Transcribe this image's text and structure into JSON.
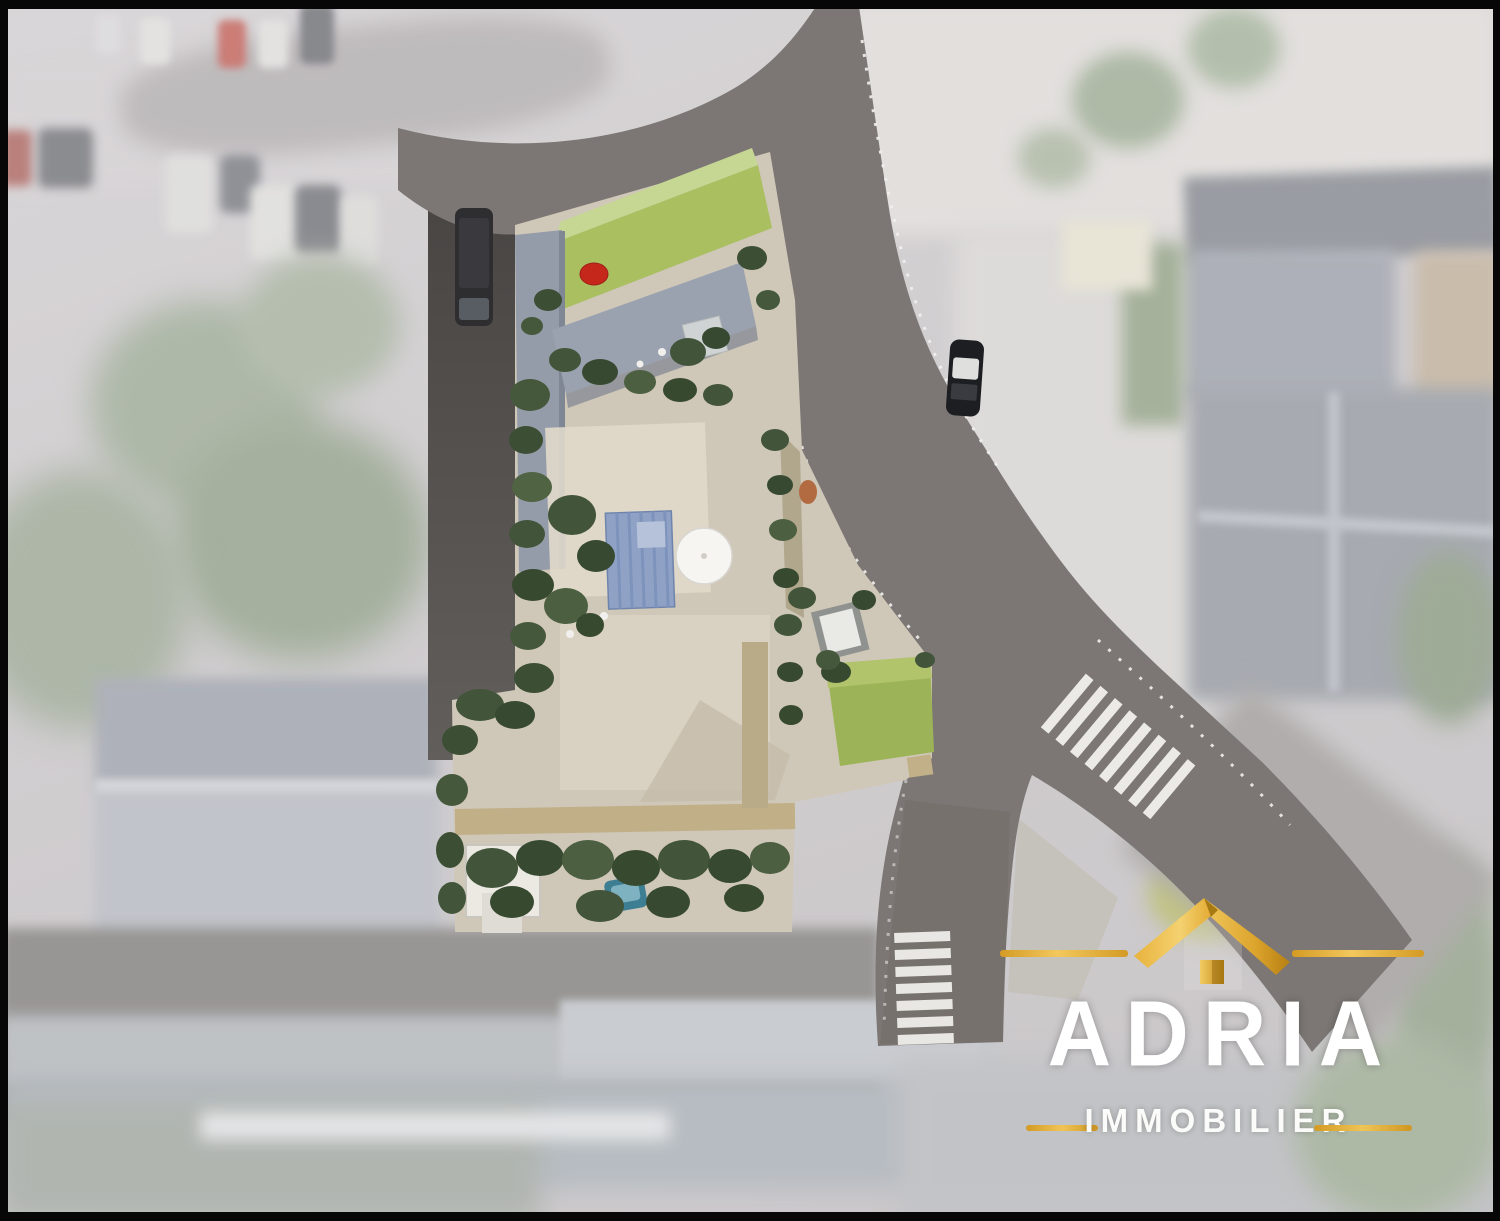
{
  "logo": {
    "brand": "ADRIA",
    "subtitle": "IMMOBILIER",
    "icon": "gold-roof-house-icon",
    "colors": {
      "gold": "#E3A72F",
      "gold_light": "#F2C75C",
      "gold_dark": "#B67F12",
      "text": "#FFFFFF"
    }
  },
  "scene": {
    "type": "aerial-site-plan-render",
    "site_features": [
      "lawn",
      "courtyard-terrace",
      "blue-pergola-roof",
      "white-parasol",
      "hedges-and-trees",
      "garden-shed",
      "patio-terrace",
      "parked-black-van",
      "parked-teal-car",
      "red-garden-table",
      "orange-table",
      "white-garden-furniture"
    ],
    "road_features": [
      "main-road",
      "road-fork",
      "zebra-crosswalk-east",
      "zebra-crosswalk-south",
      "dashed-edge-lines",
      "sidewalk",
      "driving-car"
    ],
    "surroundings": [
      "parking-lot-with-cars",
      "residential-roofs",
      "tree-canopies",
      "faded-photo-overlay"
    ],
    "palette": {
      "road": "#7C7774",
      "road_dark": "#5A5755",
      "sidewalk": "#CBC7C1",
      "lawn": "#A9BF60",
      "courtyard": "#D8D0C2",
      "hedge": "#44563A",
      "roof_blue_gray": "#99A0AE",
      "pergola": "#8FA2C6",
      "accent_red": "#C5271B",
      "teal_car": "#3E7E93",
      "tan_path": "#C0AE83",
      "background_fade": "#BDB9BC"
    }
  }
}
